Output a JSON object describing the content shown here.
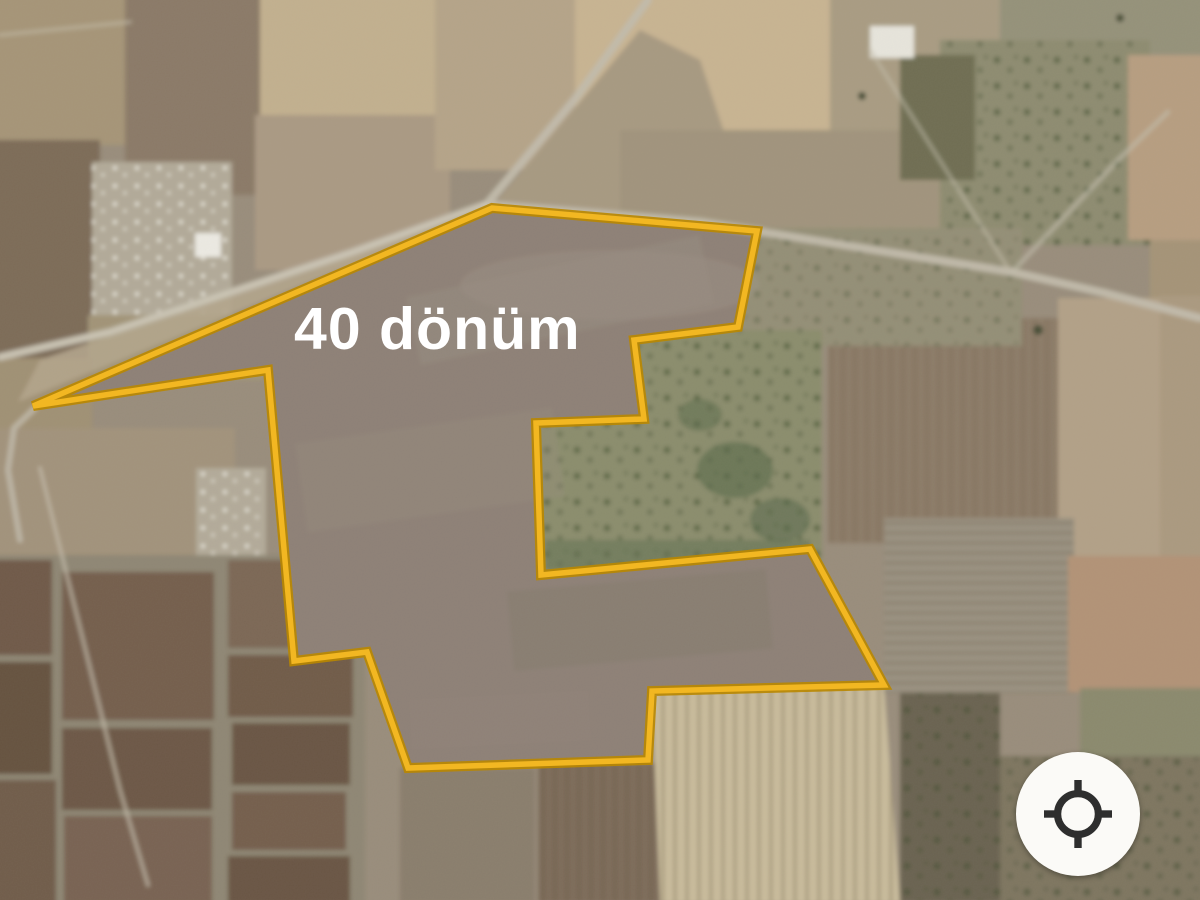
{
  "map": {
    "view_type": "satellite",
    "area_label": {
      "text": "40 dönüm",
      "color": "#ffffff"
    },
    "parcel": {
      "outline_color": "#f2b722",
      "outline_edge_color": "#b98700",
      "outline_points": [
        [
          33,
          406
        ],
        [
          492,
          208
        ],
        [
          757,
          231
        ],
        [
          738,
          327
        ],
        [
          634,
          340
        ],
        [
          644,
          419
        ],
        [
          536,
          423
        ],
        [
          541,
          575
        ],
        [
          810,
          549
        ],
        [
          884,
          685
        ],
        [
          652,
          691
        ],
        [
          648,
          760
        ],
        [
          408,
          768
        ],
        [
          367,
          652
        ],
        [
          294,
          661
        ],
        [
          268,
          370
        ]
      ]
    },
    "controls": {
      "my_location_button": {
        "icon": "my-location-icon",
        "background": "#fbfaf7",
        "icon_color": "#2e2e2e"
      }
    }
  }
}
